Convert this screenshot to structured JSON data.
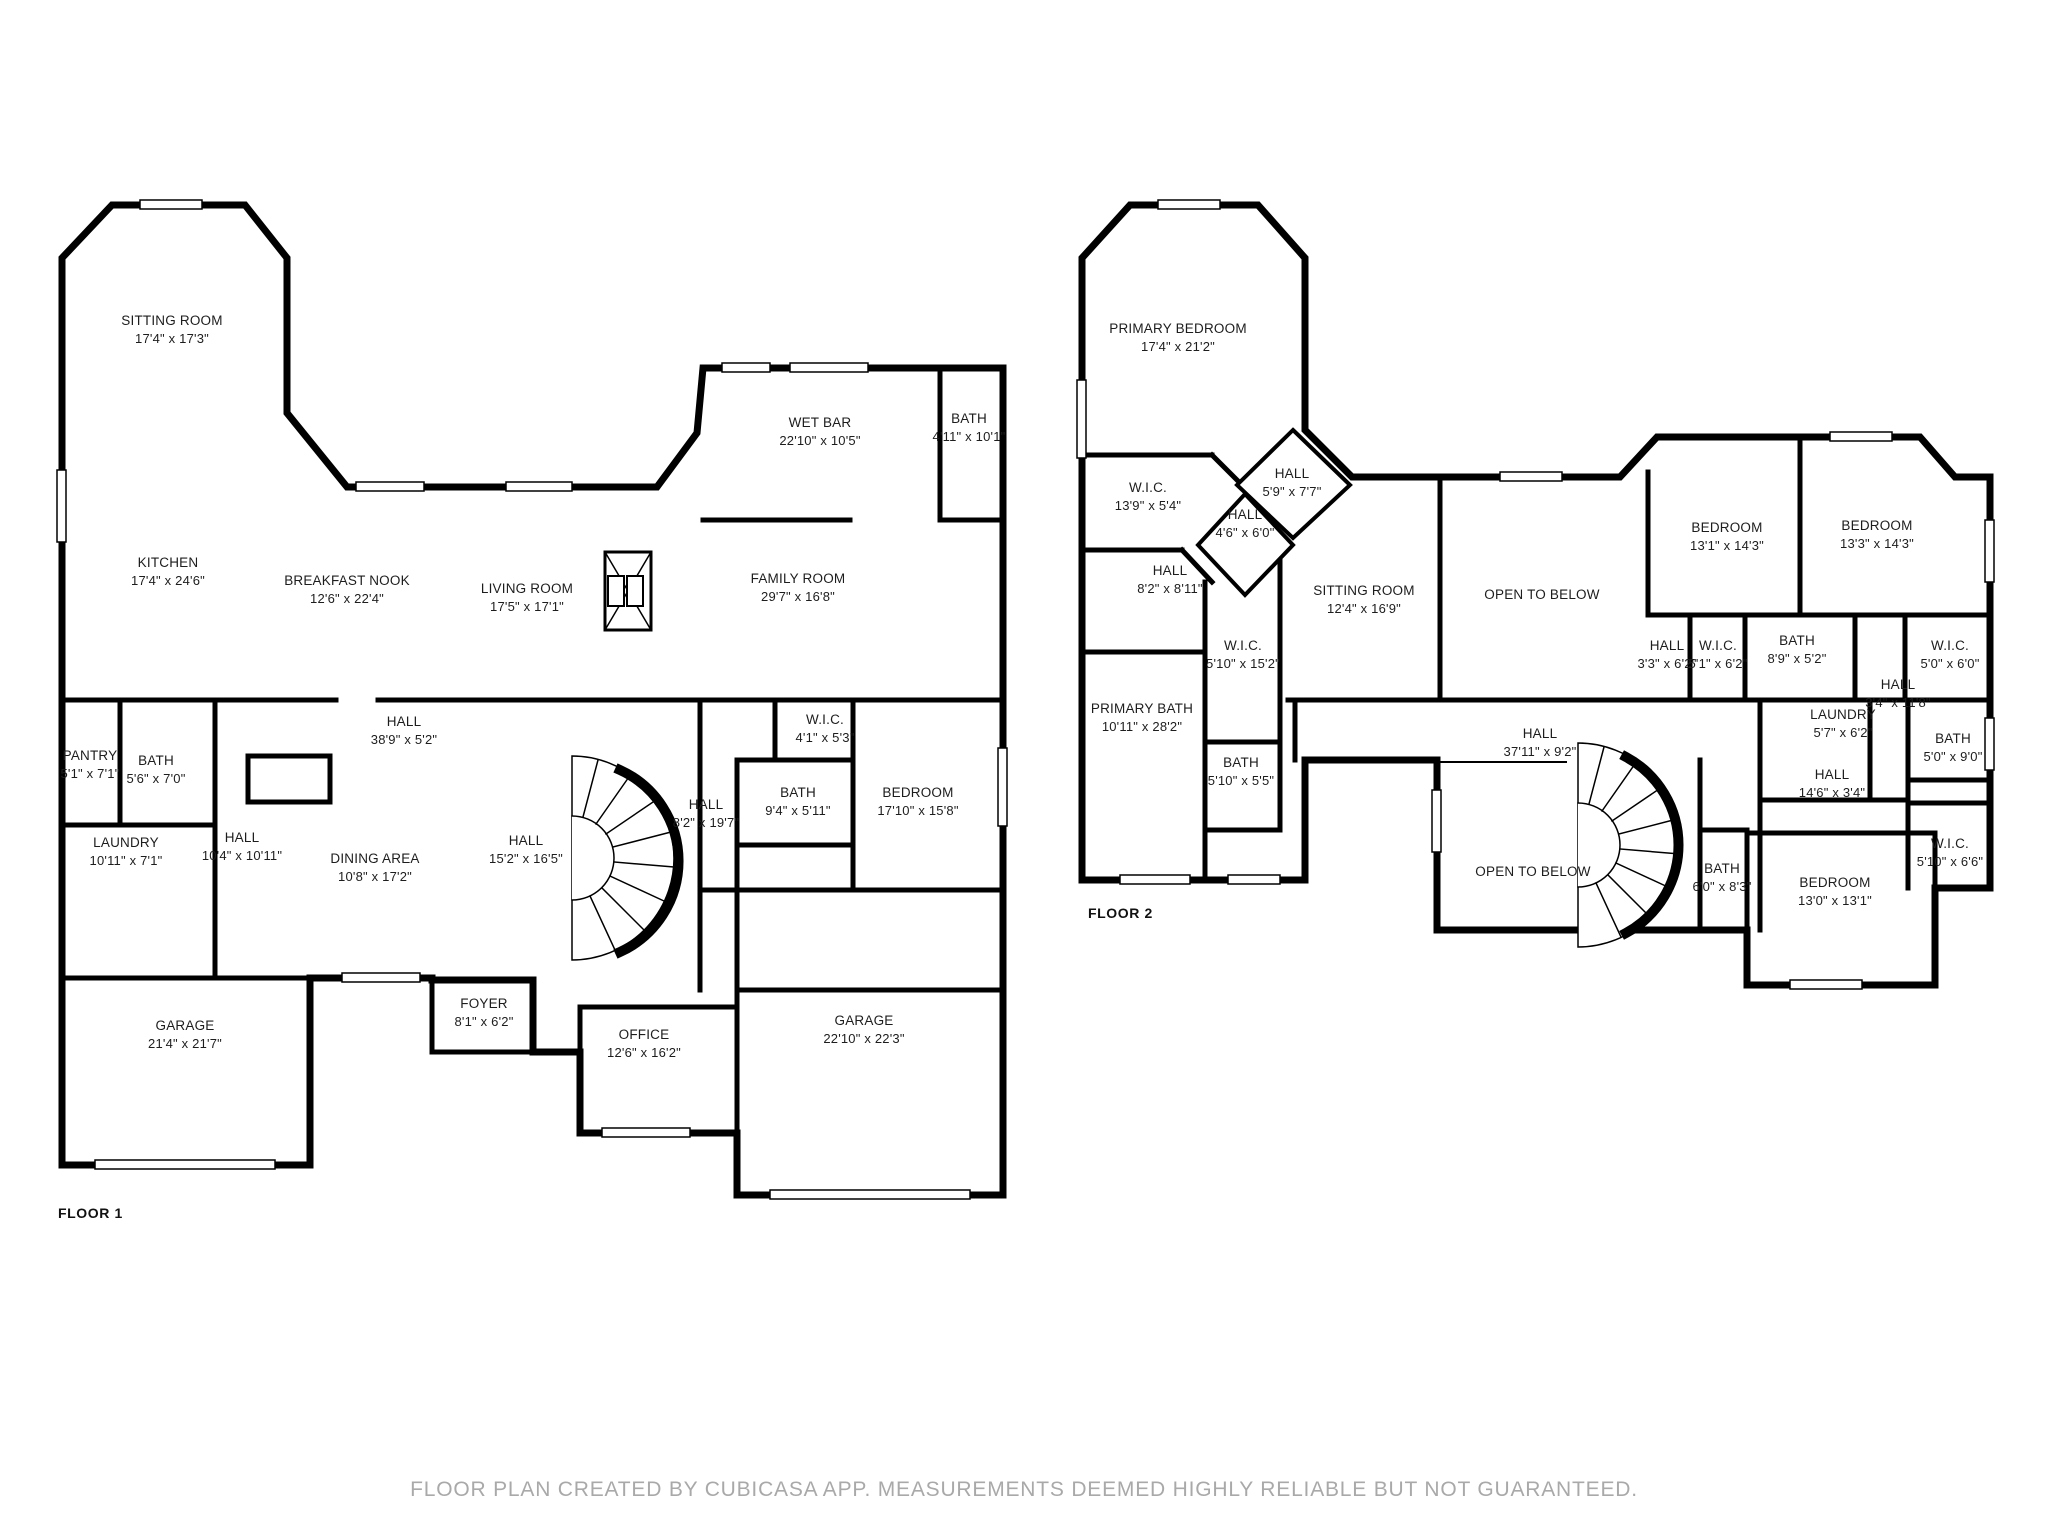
{
  "page": {
    "background": "#ffffff",
    "wall_color": "#000000",
    "label_color": "#1d1d1d",
    "footer_color": "#a9a9a9"
  },
  "footer": {
    "text": "FLOOR PLAN CREATED BY CUBICASA APP. MEASUREMENTS DEEMED HIGHLY RELIABLE BUT NOT GUARANTEED."
  },
  "floors": [
    {
      "id": "floor-1",
      "label": "FLOOR 1",
      "label_pos": {
        "x": 58,
        "y": 1205
      },
      "rooms": [
        {
          "name": "SITTING ROOM",
          "dims": "17'4\" x 17'3\"",
          "x": 172,
          "y": 330
        },
        {
          "name": "KITCHEN",
          "dims": "17'4\" x 24'6\"",
          "x": 168,
          "y": 572
        },
        {
          "name": "BREAKFAST NOOK",
          "dims": "12'6\" x 22'4\"",
          "x": 347,
          "y": 590
        },
        {
          "name": "LIVING ROOM",
          "dims": "17'5\" x 17'1\"",
          "x": 527,
          "y": 598
        },
        {
          "name": "WET BAR",
          "dims": "22'10\" x 10'5\"",
          "x": 820,
          "y": 432
        },
        {
          "name": "BATH",
          "dims": "4'11\" x 10'1\"",
          "x": 969,
          "y": 428
        },
        {
          "name": "FAMILY ROOM",
          "dims": "29'7\" x 16'8\"",
          "x": 798,
          "y": 588
        },
        {
          "name": "PANTRY",
          "dims": "5'1\" x 7'1\"",
          "x": 90,
          "y": 765
        },
        {
          "name": "BATH",
          "dims": "5'6\" x 7'0\"",
          "x": 156,
          "y": 770
        },
        {
          "name": "HALL",
          "dims": "38'9\" x 5'2\"",
          "x": 404,
          "y": 731
        },
        {
          "name": "LAUNDRY",
          "dims": "10'11\" x 7'1\"",
          "x": 126,
          "y": 852
        },
        {
          "name": "HALL",
          "dims": "10'4\" x 10'11\"",
          "x": 242,
          "y": 847
        },
        {
          "name": "DINING AREA",
          "dims": "10'8\" x 17'2\"",
          "x": 375,
          "y": 868
        },
        {
          "name": "HALL",
          "dims": "15'2\" x 16'5\"",
          "x": 526,
          "y": 850
        },
        {
          "name": "W.I.C.",
          "dims": "4'1\" x 5'3\"",
          "x": 825,
          "y": 729
        },
        {
          "name": "HALL",
          "dims": "8'2\" x 19'7\"",
          "x": 706,
          "y": 814
        },
        {
          "name": "BATH",
          "dims": "9'4\" x 5'11\"",
          "x": 798,
          "y": 802
        },
        {
          "name": "BEDROOM",
          "dims": "17'10\" x 15'8\"",
          "x": 918,
          "y": 802
        },
        {
          "name": "GARAGE",
          "dims": "21'4\" x 21'7\"",
          "x": 185,
          "y": 1035
        },
        {
          "name": "FOYER",
          "dims": "8'1\" x 6'2\"",
          "x": 484,
          "y": 1013
        },
        {
          "name": "OFFICE",
          "dims": "12'6\" x 16'2\"",
          "x": 644,
          "y": 1044
        },
        {
          "name": "GARAGE",
          "dims": "22'10\" x 22'3\"",
          "x": 864,
          "y": 1030
        }
      ]
    },
    {
      "id": "floor-2",
      "label": "FLOOR 2",
      "label_pos": {
        "x": 1088,
        "y": 905
      },
      "rooms": [
        {
          "name": "PRIMARY BEDROOM",
          "dims": "17'4\" x 21'2\"",
          "x": 1178,
          "y": 338
        },
        {
          "name": "W.I.C.",
          "dims": "13'9\" x 5'4\"",
          "x": 1148,
          "y": 497
        },
        {
          "name": "HALL",
          "dims": "5'9\" x 7'7\"",
          "x": 1292,
          "y": 483
        },
        {
          "name": "HALL",
          "dims": "4'6\" x 6'0\"",
          "x": 1245,
          "y": 524
        },
        {
          "name": "HALL",
          "dims": "8'2\" x 8'11\"",
          "x": 1170,
          "y": 580
        },
        {
          "name": "SITTING ROOM",
          "dims": "12'4\" x 16'9\"",
          "x": 1364,
          "y": 600
        },
        {
          "name": "W.I.C.",
          "dims": "5'10\" x 15'2\"",
          "x": 1243,
          "y": 655
        },
        {
          "name": "PRIMARY BATH",
          "dims": "10'11\" x 28'2\"",
          "x": 1142,
          "y": 718
        },
        {
          "name": "BATH",
          "dims": "5'10\" x 5'5\"",
          "x": 1241,
          "y": 772
        },
        {
          "name": "OPEN TO BELOW",
          "dims": "",
          "x": 1542,
          "y": 595
        },
        {
          "name": "BEDROOM",
          "dims": "13'1\" x 14'3\"",
          "x": 1727,
          "y": 537
        },
        {
          "name": "BEDROOM",
          "dims": "13'3\" x 14'3\"",
          "x": 1877,
          "y": 535
        },
        {
          "name": "HALL",
          "dims": "3'3\" x 6'2\"",
          "x": 1667,
          "y": 655
        },
        {
          "name": "W.I.C.",
          "dims": "5'1\" x 6'2\"",
          "x": 1718,
          "y": 655
        },
        {
          "name": "BATH",
          "dims": "8'9\" x 5'2\"",
          "x": 1797,
          "y": 650
        },
        {
          "name": "W.I.C.",
          "dims": "5'0\" x 6'0\"",
          "x": 1950,
          "y": 655
        },
        {
          "name": "LAUNDRY",
          "dims": "5'7\" x 6'2\"",
          "x": 1843,
          "y": 724
        },
        {
          "name": "HALL",
          "dims": "3'4\" x 11'8\"",
          "x": 1898,
          "y": 694
        },
        {
          "name": "BATH",
          "dims": "5'0\" x 9'0\"",
          "x": 1953,
          "y": 748
        },
        {
          "name": "HALL",
          "dims": "14'6\" x 3'4\"",
          "x": 1832,
          "y": 784
        },
        {
          "name": "HALL",
          "dims": "37'11\" x 9'2\"",
          "x": 1540,
          "y": 743
        },
        {
          "name": "OPEN TO BELOW",
          "dims": "",
          "x": 1533,
          "y": 872
        },
        {
          "name": "BATH",
          "dims": "6'0\" x 8'3\"",
          "x": 1722,
          "y": 878
        },
        {
          "name": "W.I.C.",
          "dims": "5'10\" x 6'6\"",
          "x": 1950,
          "y": 853
        },
        {
          "name": "BEDROOM",
          "dims": "13'0\" x 13'1\"",
          "x": 1835,
          "y": 892
        }
      ]
    }
  ]
}
